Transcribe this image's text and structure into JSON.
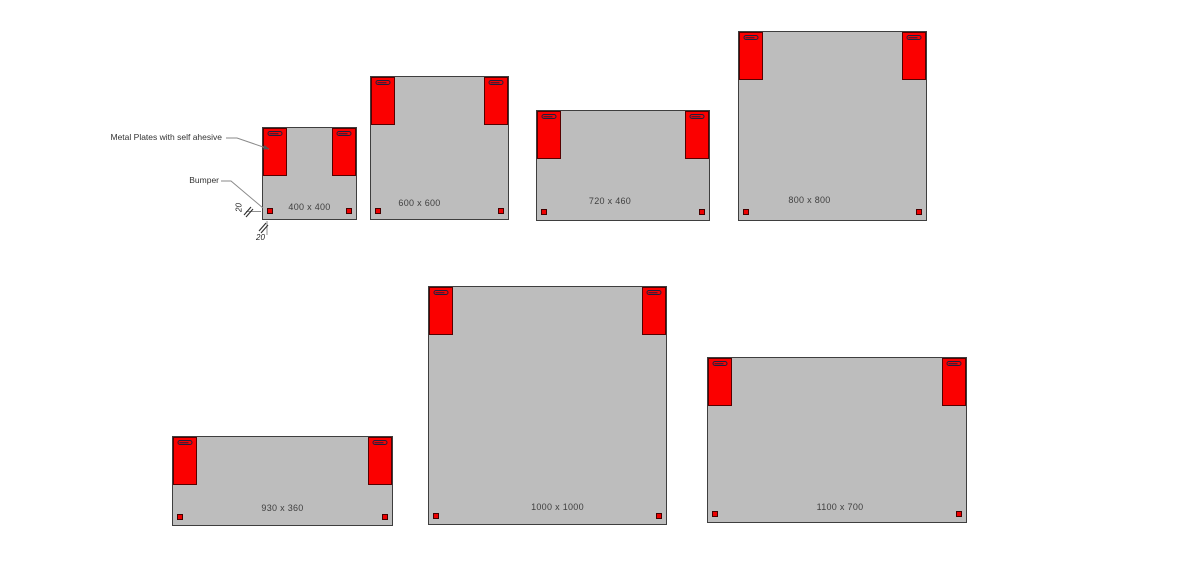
{
  "annotations": {
    "metal_plates_label": "Metal Plates with self ahesive",
    "bumper_label": "Bumper",
    "dim_left": "20",
    "dim_bottom": "20"
  },
  "panels": [
    {
      "label": "400 x 400"
    },
    {
      "label": "600 x 600"
    },
    {
      "label": "720 x 460"
    },
    {
      "label": "800 x 800"
    },
    {
      "label": "930 x 360"
    },
    {
      "label": "1000 x 1000"
    },
    {
      "label": "1100 x 700"
    }
  ],
  "colors": {
    "panel_fill": "#bdbdbd",
    "panel_border": "#3e3e3e",
    "plate_fill": "#fb0000",
    "plate_border": "#550000",
    "slot_color": "#20203f",
    "bumper_fill": "#ee0000",
    "label_text": "#3f3f3f",
    "leader_line": "#8a8a8a",
    "background": "#ffffff"
  }
}
